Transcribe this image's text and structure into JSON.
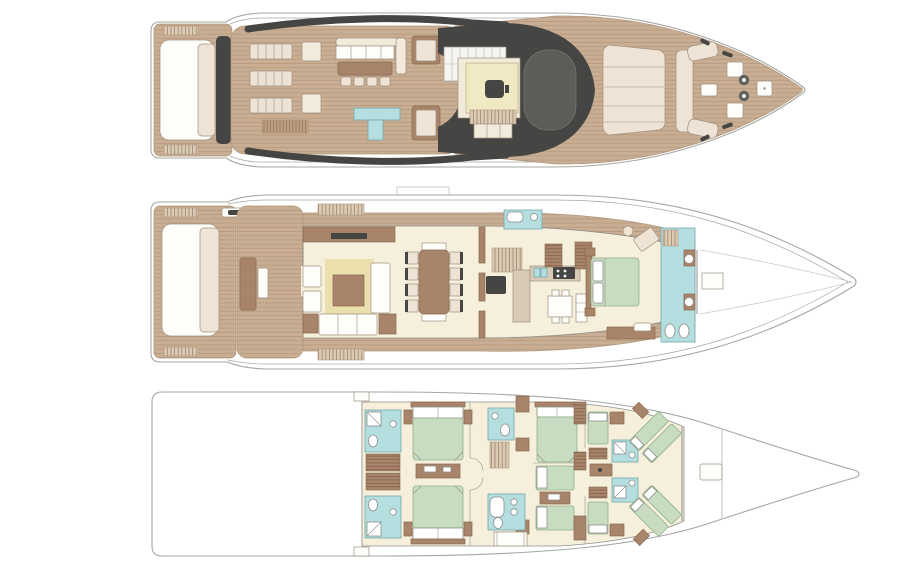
{
  "meta": {
    "type": "yacht-deck-plans",
    "orientation": "bow-right",
    "deck_count": 3,
    "background": "#ffffff"
  },
  "palette": {
    "outline": "#a6a6a3",
    "wallline": "#8f8f8a",
    "furnline": "#a09080",
    "wood": "#c9ae93",
    "woodline": "#b1967b",
    "brown": "#a8846a",
    "brownline": "#8a684e",
    "cream": "#f2ebdc",
    "pinkpad": "#eee3d5",
    "floor": "#f5efdb",
    "rug": "#eadfad",
    "paleyellow": "#f0e9c4",
    "teal": "#b4dedf",
    "tealline": "#74a9ac",
    "green": "#c8dcc2",
    "greenline": "#92b18a",
    "dark": "#454543",
    "dark2": "#5c5c59",
    "stairbg": "#dbcbb5",
    "stairline": "#9b8570",
    "gratebg": "#bfa283",
    "grateline": "#8c7156"
  },
  "decks": [
    {
      "id": "sundeck",
      "position": "top",
      "features": [
        "aft-sunpad",
        "stair-treads",
        "lounge-chair-rows",
        "side-tables",
        "teak-grating",
        "l-shaped-sofa",
        "bar-table-with-stools",
        "wet-bar-counter",
        "chaise-loungers",
        "hardtop-helm-station",
        "helm-seat",
        "windscreen",
        "foredeck-sunpad",
        "bow-c-sofa",
        "deck-hatches",
        "anchor-windlass",
        "bow-cleats"
      ]
    },
    {
      "id": "main-deck",
      "position": "middle",
      "features": [
        "aft-platform-sunpad",
        "tender-davit",
        "cockpit-seating",
        "boarding-stairs",
        "side-decks",
        "salon-sideboard-tv",
        "armchairs",
        "rug-with-coffee-table",
        "sofa",
        "chaise",
        "dining-table-eight-chairs",
        "day-head",
        "staircase",
        "dumbwaiter",
        "galley-counters",
        "galley-dinette",
        "fridge",
        "wardrobes",
        "master-cabin-double-bed",
        "vanity-desk",
        "foot-bench",
        "master-bathroom-full-beam",
        "twin-sinks",
        "wc-bidet",
        "foredeck-hatch",
        "radar-mast-outline"
      ]
    },
    {
      "id": "lower-deck",
      "position": "bottom",
      "features": [
        "engine-room-void",
        "watertight-bulkheads",
        "port-ensuite-bathrooms",
        "linen-lockers",
        "vip-cabin-forward-bed",
        "vip-cabin-aft-bed",
        "central-dresser",
        "guest-bathroom-upper",
        "staircase",
        "guest-bathroom-lower-with-tub",
        "vanity-table",
        "guest-double-cabin",
        "guest-twin-cabin",
        "wardrobes",
        "crew-single-berths",
        "crew-bathrooms",
        "crew-angled-bunks",
        "crew-mess-counter",
        "bow-storage-hatch"
      ]
    }
  ]
}
